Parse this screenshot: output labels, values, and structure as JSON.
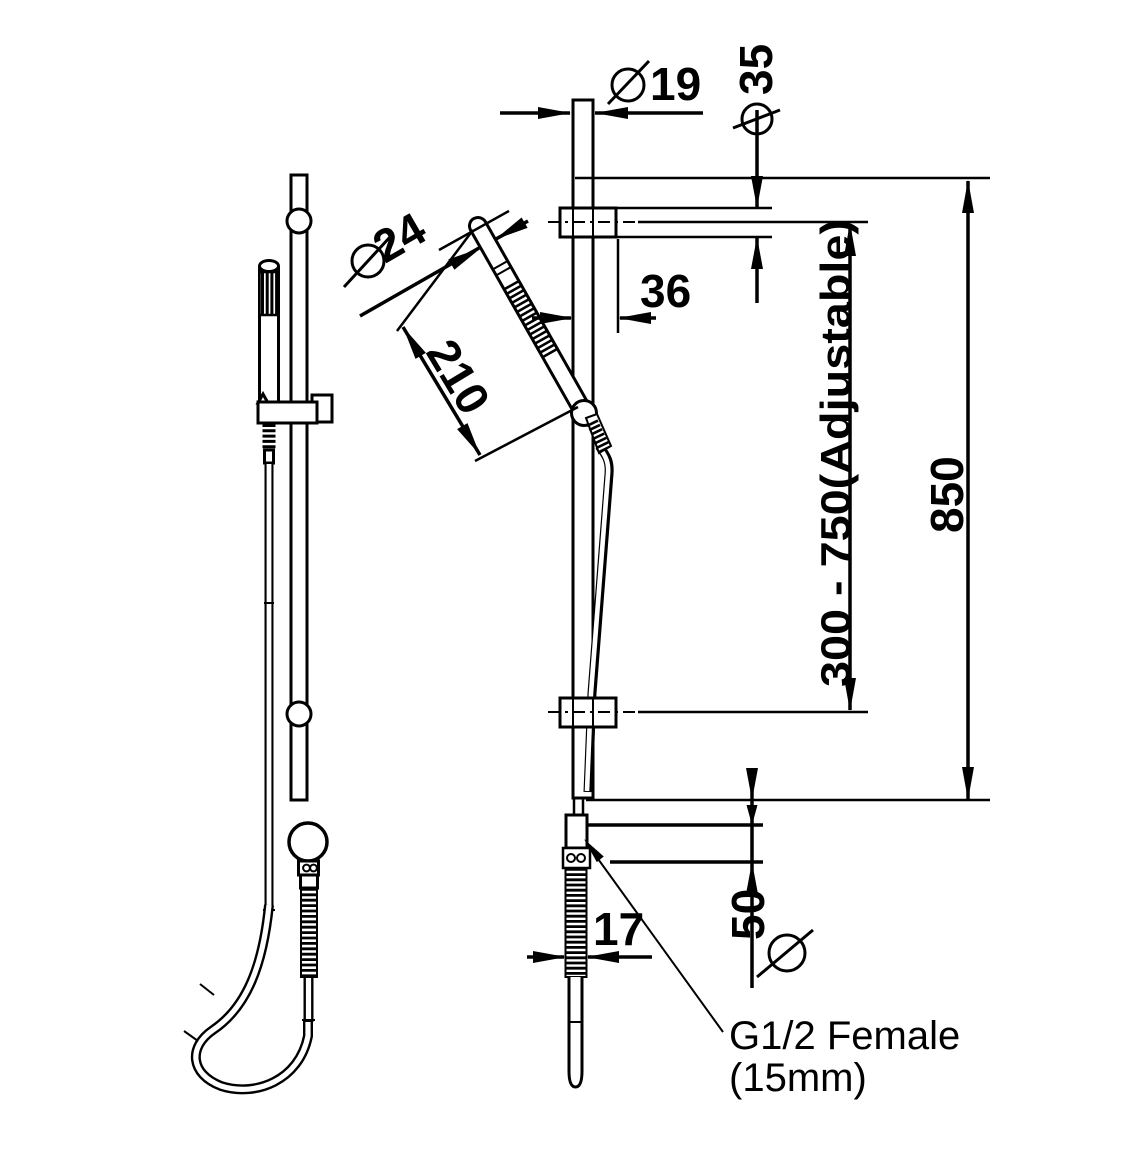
{
  "page": {
    "background": "#ffffff",
    "ink": "#000000"
  },
  "dimensions": {
    "rail_diameter": {
      "symbol": "⌀",
      "value": "19"
    },
    "bracket_flange_diameter": {
      "symbol": "⌀",
      "value": "35"
    },
    "handset_diameter": {
      "symbol": "⌀",
      "value": "24"
    },
    "handset_length": {
      "symbol": "",
      "value": "210"
    },
    "rail_to_wall_offset": {
      "symbol": "",
      "value": "36"
    },
    "bracket_centres": {
      "symbol": "",
      "value": "300 - 750(Adjustable)"
    },
    "overall_length": {
      "symbol": "",
      "value": "850"
    },
    "hose_diameter": {
      "symbol": "",
      "value": "17"
    },
    "outlet_flange_diameter": {
      "symbol": "⌀",
      "value": "50"
    }
  },
  "notes": {
    "inlet_connection": {
      "line1": "G1/2 Female",
      "line2": "(15mm)"
    }
  }
}
